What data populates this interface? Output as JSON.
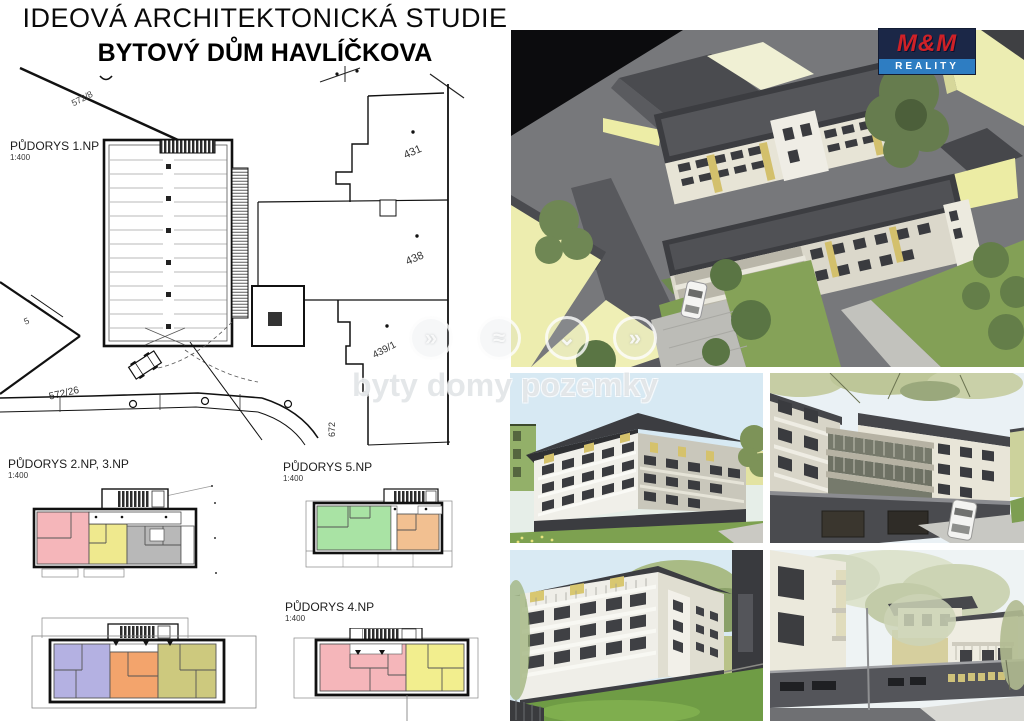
{
  "header": {
    "title": "IDEOVÁ ARCHITEKTONICKÁ STUDIE",
    "subtitle": "BYTOVÝ DŮM HAVLÍČKOVA"
  },
  "brand": {
    "name": "M&M",
    "tagline": "REALITY"
  },
  "watermark": {
    "text": "byty domy pozemky",
    "icon_glyphs": [
      "»",
      "≈",
      "⌄",
      "»"
    ]
  },
  "site_plan": {
    "label": "PŮDORYS 1.NP",
    "scale": "1:400",
    "parcels": [
      "572/8",
      "431",
      "438",
      "439/1",
      "572/26",
      "672",
      "5"
    ]
  },
  "floor_plans": [
    {
      "label": "PŮDORYS 2.NP, 3.NP",
      "scale": "1:400",
      "unit_colors": [
        "#f5b6ba",
        "#efe98e",
        "#b8b8b8",
        "#b4b1e2",
        "#f3a46c",
        "#cdc97e"
      ]
    },
    {
      "label": "PŮDORYS 5.NP",
      "scale": "1:400",
      "unit_colors": [
        "#a9e3a4",
        "#f2c091"
      ]
    },
    {
      "label": "PŮDORYS 4.NP",
      "scale": "1:400",
      "unit_colors": [
        "#f5b6ba",
        "#f2ee8e"
      ]
    }
  ],
  "colors": {
    "logo_red": "#cf2127",
    "logo_navy": "#1b2747",
    "logo_blue": "#2e7dc2",
    "roof_dark": "#3c3d41",
    "facade_cream": "#e7e4d6",
    "accent_yellow": "#d3c06c",
    "grass_green": "#7f9e53",
    "sky_blue": "#d7e9f3"
  }
}
